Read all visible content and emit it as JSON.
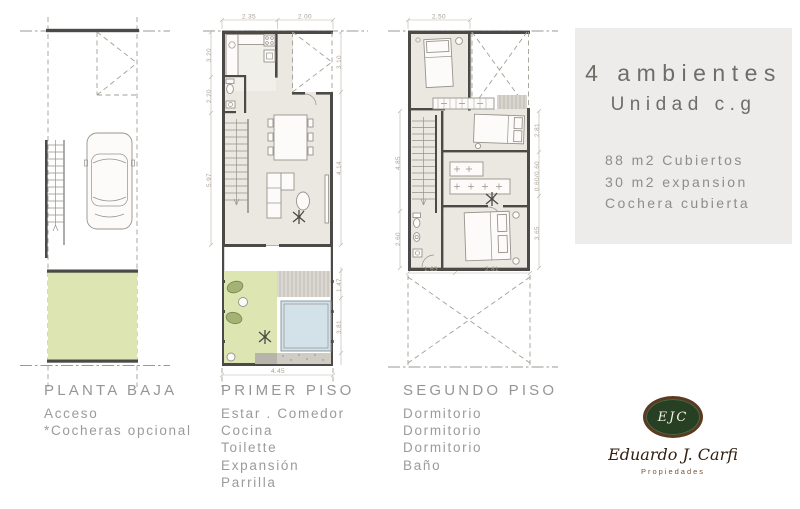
{
  "plans": {
    "planta_baja": {
      "title": "PLANTA BAJA",
      "features": [
        "Acceso",
        "*Cocheras opcional"
      ]
    },
    "primer_piso": {
      "title": "PRIMER PISO",
      "features": [
        "Estar . Comedor",
        "Cocina",
        "Toilette",
        "Expansión",
        "Parrilla"
      ],
      "dims": {
        "top_left": "2.35",
        "top_right": "2.00",
        "left_upper": "3.20",
        "left_mid": "2.20",
        "left_lower": "5.97",
        "right_upper": "3.10",
        "right_mid": "4.14",
        "right_deck": "1.47",
        "right_pool": "3.81",
        "bottom": "4.45"
      }
    },
    "segundo_piso": {
      "title": "SEGUNDO PISO",
      "features": [
        "Dormitorio",
        "Dormitorio",
        "Dormitorio",
        "Baño"
      ],
      "dims": {
        "top": "2.50",
        "left_upper": "4.85",
        "left_lower": "2.60",
        "right_upper": "2.81",
        "right_mid": "0.60/0.60",
        "right_lower": "3.65",
        "bottom_left": "1.63",
        "bottom_right": "2.81"
      }
    }
  },
  "info_panel": {
    "title_line1": "4 ambientes",
    "title_line2": "Unidad c.g",
    "details": [
      "88 m2 Cubiertos",
      "30 m2 expansion",
      "Cochera cubierta"
    ]
  },
  "logo": {
    "monogram": "EJC",
    "name": "Eduardo J. Carfi",
    "tagline": "Propiedades"
  },
  "colors": {
    "wall": "#4b4a46",
    "floor": "#ebe8e1",
    "green_area": "#dde6b3",
    "pool": "#d3e1e9",
    "panel_bg": "#edecea",
    "label_text": "#9a9a9a",
    "dim_text": "#a89f92",
    "logo_green": "#273f22",
    "logo_brown": "#5c3a22"
  }
}
